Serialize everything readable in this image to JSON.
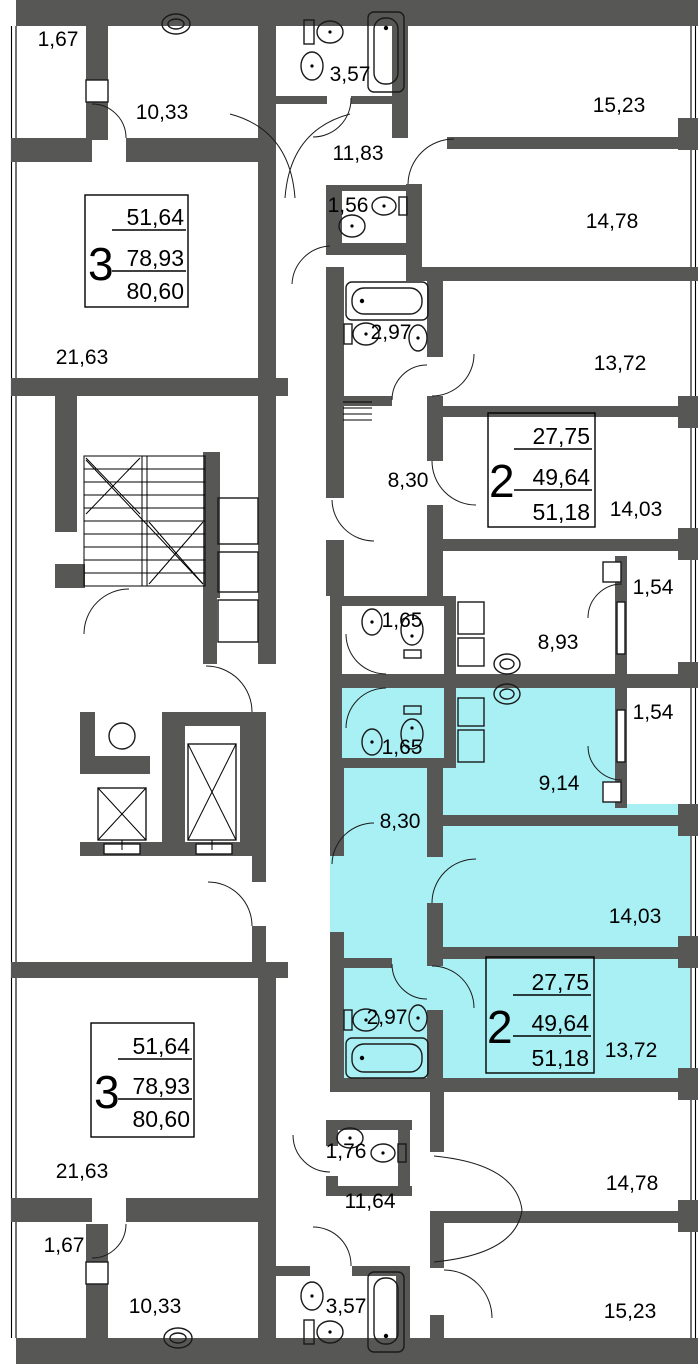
{
  "plan": {
    "title": "Floor plan with highlighted 2-room apartment",
    "wall_color": "#575756",
    "highlight_color": "#A8F0F4",
    "apartments": {
      "apt3_top": {
        "rooms": "3",
        "area_living": "51,64",
        "area_apartment": "78,93",
        "area_total": "80,60"
      },
      "apt2_top": {
        "rooms": "2",
        "area_living": "27,75",
        "area_apartment": "49,64",
        "area_total": "51,18"
      },
      "apt2_bottom": {
        "rooms": "2",
        "area_living": "27,75",
        "area_apartment": "49,64",
        "area_total": "51,18"
      },
      "apt3_bottom": {
        "rooms": "3",
        "area_living": "51,64",
        "area_apartment": "78,93",
        "area_total": "80,60"
      }
    },
    "labels": {
      "t_balcony": "1,67",
      "t_kitchen": "10,33",
      "t_bath": "3,57",
      "t_hall": "11,83",
      "t_room1": "15,23",
      "t_wc": "1,56",
      "t_room2": "14,78",
      "t_bath2": "2,97",
      "t_room3": "13,72",
      "t_living": "21,63",
      "t_hall2": "8,30",
      "t_room4": "14,03",
      "t_balcony2": "1,54",
      "t_wc2": "1,65",
      "t_corridor": "8,93",
      "c_balcony": "1,54",
      "c_wc": "1,65",
      "c_kitchen": "9,14",
      "c_hall": "8,30",
      "c_room1": "14,03",
      "c_room2": "13,72",
      "c_bath": "2,97",
      "b_living": "21,63",
      "b_balcony": "1,67",
      "b_kitchen": "10,33",
      "b_wc": "1,76",
      "b_hall": "11,64",
      "b_room1": "14,78",
      "b_bath": "3,57",
      "b_room2": "15,23"
    }
  }
}
